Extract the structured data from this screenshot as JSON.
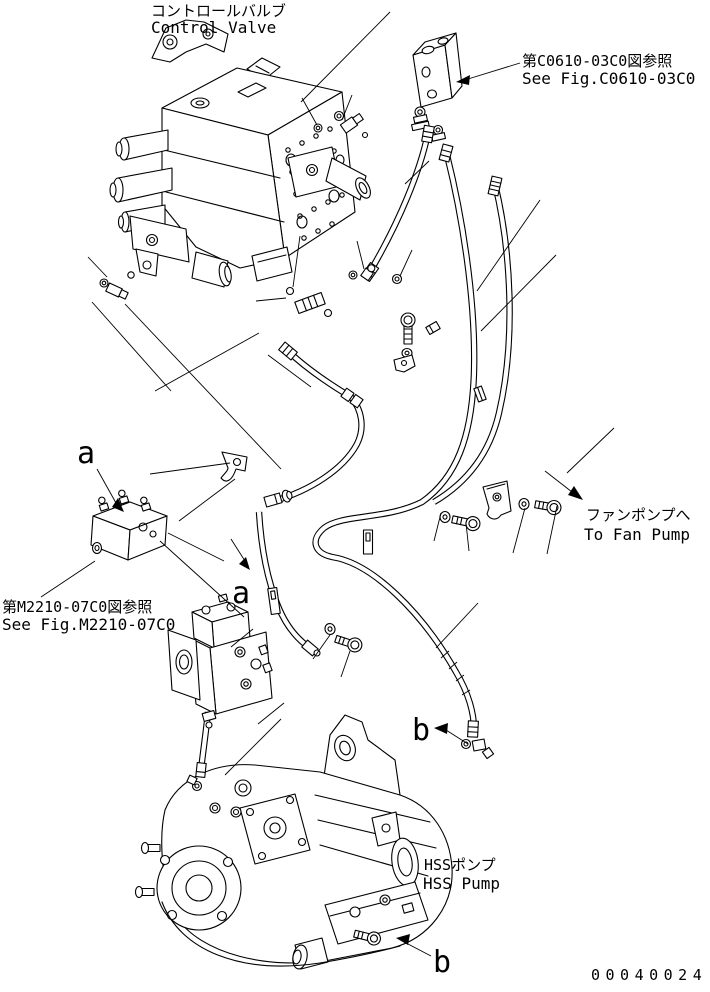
{
  "drawing": {
    "background": "#ffffff",
    "line_color": "#000000",
    "number": "00040024",
    "callouts": {
      "control_valve": {
        "jp": "コントロールバルブ",
        "en": "Control Valve"
      },
      "see_fig_c0610": {
        "jp": "第C0610-03C0図参照",
        "en": "See Fig.C0610-03C0"
      },
      "see_fig_m2210": {
        "jp": "第M2210-07C0図参照",
        "en": "See Fig.M2210-07C0"
      },
      "to_fan_pump": {
        "jp": "ファンポンプへ",
        "en": "To Fan Pump"
      },
      "hss_pump": {
        "jp": "HSSポンプ",
        "en": "HSS Pump"
      },
      "point_a": "a",
      "point_b": "b"
    }
  }
}
